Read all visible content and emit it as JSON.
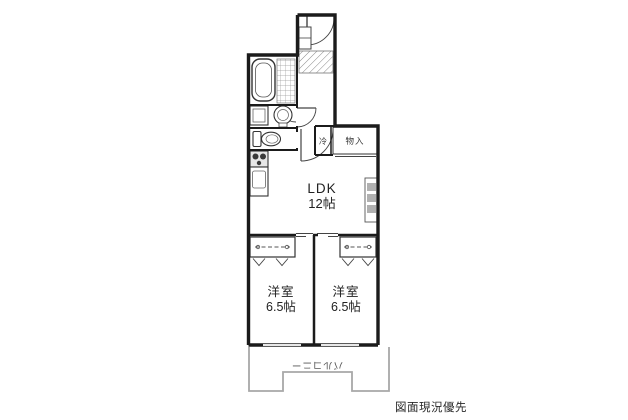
{
  "plan": {
    "rooms": {
      "ldk": {
        "name": "LDK",
        "size": "12帖"
      },
      "bedroom_left": {
        "name": "洋室",
        "size": "6.5帖"
      },
      "bedroom_right": {
        "name": "洋室",
        "size": "6.5帖"
      },
      "closet": {
        "label": "物入"
      },
      "fridge_space": {
        "label": "冷"
      },
      "balcony": {
        "label": "バルコニー"
      }
    },
    "note": "図面現況優先",
    "colors": {
      "wall": "#1b1b1b",
      "balcony_line": "#a8a8a8",
      "text": "#222222",
      "fixture": "#444444"
    }
  }
}
